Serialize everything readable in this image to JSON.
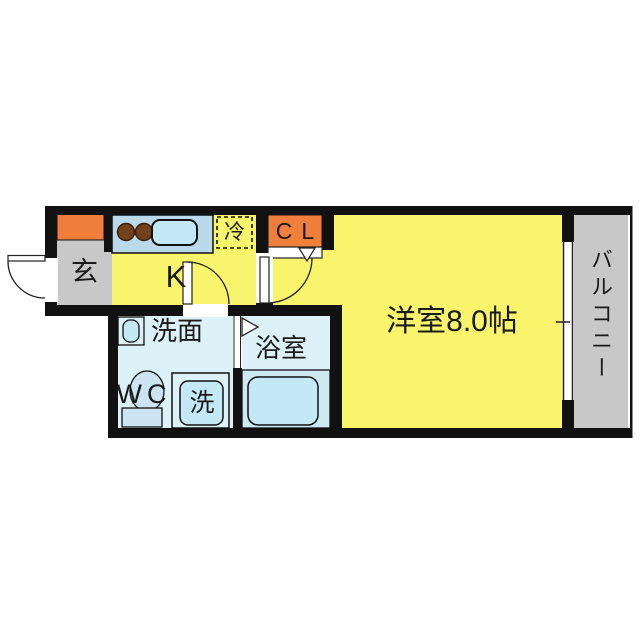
{
  "document_type": "apartment-floor-plan",
  "rooms": {
    "entrance": {
      "label": "玄"
    },
    "kitchen": {
      "label": "K"
    },
    "refrigerator": {
      "label": "冷"
    },
    "closet": {
      "label": "CL"
    },
    "western_room": {
      "label": "洋室8.0帖",
      "size_tatami": "8.0"
    },
    "balcony": {
      "label": "バルコニー"
    },
    "washroom": {
      "label": "洗面"
    },
    "toilet": {
      "label": "WC"
    },
    "washing_machine": {
      "label": "洗"
    },
    "bathroom": {
      "label": "浴室"
    }
  },
  "icons": [
    "entrance-door-arc-icon",
    "kitchen-door-arc-icon",
    "room-door-arc-icon",
    "closet-folding-door-icon",
    "bathroom-folding-door-icon",
    "stove-burners-icon",
    "kitchen-sink-icon",
    "washbasin-icon",
    "toilet-icon",
    "washing-machine-icon",
    "bathtub-icon",
    "window-icon"
  ],
  "colors": {
    "wall": "#111111",
    "yellow": "#F8F46C",
    "orange": "#F07F3C",
    "gray": "#C8C8C8",
    "wet": "#DCF2F8",
    "counter": "#BAD9EA",
    "fixture": "#C3E9F6",
    "toilet": "#CCE3F2",
    "burner": "#74411F",
    "surround": "#CDE9F2",
    "line": "#222222",
    "text": "#1A1A1A",
    "bg": "#FFFFFF"
  }
}
